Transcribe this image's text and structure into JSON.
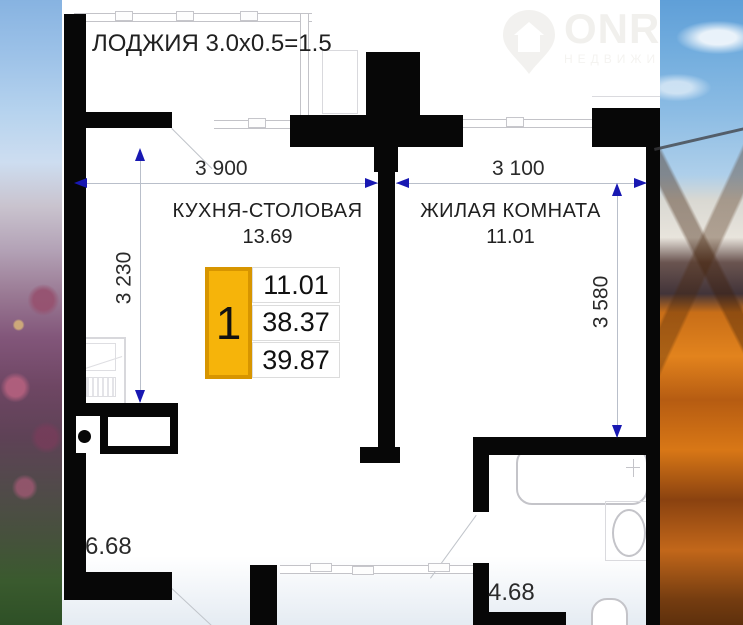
{
  "watermark": {
    "brand": "ONRE",
    "subtitle": "НЕДВИЖИМОС",
    "icon": "house-pin-icon"
  },
  "plan": {
    "loggia_label": "ЛОДЖИЯ 3.0х0.5=1.5",
    "rooms": {
      "kitchen": {
        "name": "КУХНЯ-СТОЛОВАЯ",
        "area": "13.69"
      },
      "living": {
        "name": "ЖИЛАЯ КОМНАТА",
        "area": "11.01"
      },
      "hall": {
        "area": "6.68"
      },
      "bathroom": {
        "area": "4.68"
      }
    },
    "dimensions": {
      "kitchen_width": "3 900",
      "living_width": "3 100",
      "kitchen_depth": "3 230",
      "living_depth": "3 580"
    },
    "info_card": {
      "room_count": "1",
      "values": [
        "11.01",
        "38.37",
        "39.87"
      ]
    }
  },
  "colors": {
    "wall": "#070707",
    "dimension_arrow": "#1818B2",
    "accent_fill": "#F6B40A",
    "accent_border": "#D79500"
  }
}
